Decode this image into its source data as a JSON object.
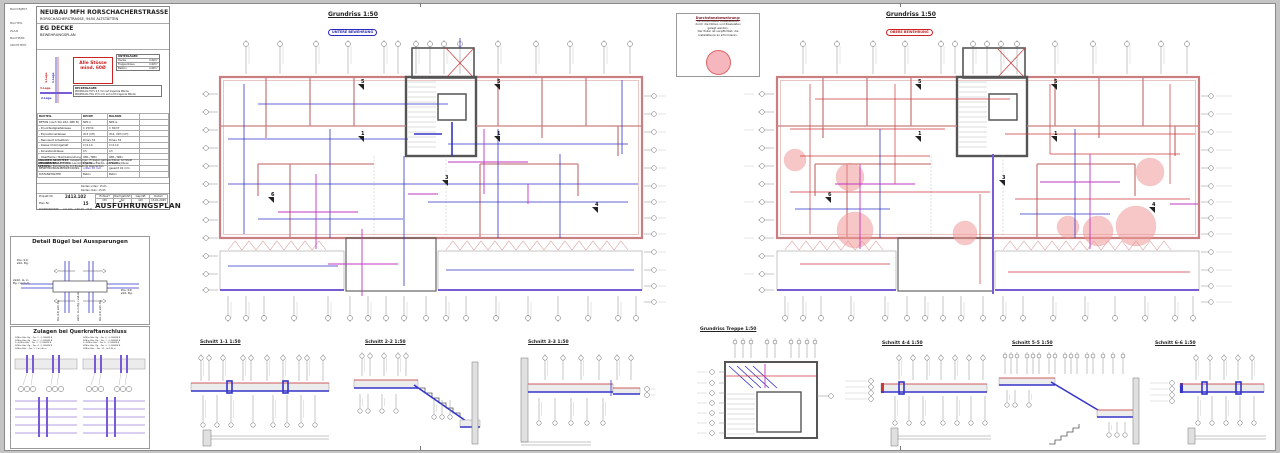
{
  "colors": {
    "red": "#cc3838",
    "blue": "#3434c8",
    "magenta": "#c234c2",
    "purple": "#7a5bd6",
    "wall_pink": "#c97f7f",
    "zone_pink": "#f29a9a"
  },
  "title_block": {
    "side_labels": [
      "BAUOBJEKT",
      "BAUTEIL",
      "PLAN",
      "BAUHERR",
      "ARCHITEKT"
    ],
    "project_name": "NEUBAU MFH RORSCHACHERSTRASSE",
    "project_address": "RORSCHACHERSTRASSE, 9450 ALTSTÄTTEN",
    "part": "EG DECKE",
    "plan_kind": "BEWEHRUNGSPLAN",
    "lage": {
      "l1": "1.Lage",
      "l2": "2.Lage",
      "l3": "3.Lage",
      "l4": "4.Lage"
    },
    "stoss1": "Alle Stösse",
    "stoss2": "mind. 60Ø",
    "unterlagen": {
      "title": "UNTERLAGEN",
      "rows": [
        {
          "k": "Decke",
          "v": "4 Ø/m²"
        },
        {
          "k": "Treppenhaus",
          "v": "4 Ø/m²"
        },
        {
          "k": "Balkon",
          "v": "4 Ø/m²"
        }
      ]
    },
    "lager": {
      "title": "DECKENLAGER:",
      "line1": "PROMOLOG TOTL 0.5 mm auf tragende Wände",
      "line2": "PROMOLOG TWL 15.5 mm auf nicht tragende Wände"
    },
    "materials": {
      "headers": [
        "BAUTEIL",
        "DECKE",
        "BALKON"
      ],
      "rows": [
        [
          "BETON (nach SIA 262, NPK B)",
          "NPK C",
          "NPK G"
        ],
        [
          "- Druckfestigkeitsklasse",
          "C 25/30",
          "C 30/37"
        ],
        [
          "- Expositionsklassen",
          "XC3 (CH)",
          "XC4, XD3 (CH)"
        ],
        [
          "- Nennwert Grösstkorn",
          "Dmax 32",
          "Dmax 32"
        ],
        [
          "- Klasse Chloridgehalt",
          "Cl 0,10",
          "Cl 0,10"
        ],
        [
          "- Konsistenzklasse",
          "C3",
          "C3"
        ],
        [
          "- Oberfläche / Nachbehandlung",
          "OB1 / NB1",
          "OB1 / NB1"
        ],
        [
          "BETONSTAHL",
          "B500B",
          "B500B"
        ],
        [
          "BEWEHRUNGSÜBERDECKUNG",
          "unten 30 mm",
          "gesamt 40 mm"
        ],
        [
          "DISTANZHALTER",
          "Beton",
          "Beton"
        ]
      ]
    },
    "angaben": [
      {
        "k": "ANGABEN ARCHITEKT:",
        "v": "Aussparungen, Einlagen gemäss Plänen Architekt"
      },
      {
        "k": "ANGABEN BAULEITUNG:",
        "v": "Leerrohre gemäss Elektro- und Sanitärplänen"
      },
      {
        "k": "SPEZIELL:",
        "v": "Durchbrüche mit Bauleitung absprechen"
      }
    ],
    "kanten1": "Kanten unten:  15.01",
    "kanten2": "Kanten oben:  15.05",
    "koord_label": "KOORDINATION:",
    "koord_line": "A-S.011 · 140.05 · 44.B",
    "project_no_label": "Projekt Nr.",
    "project_no": "2413.102",
    "plan_no_label": "Plan Nr.",
    "plan_no": "15",
    "approvals": {
      "h1": "Entwurf",
      "h2": "Nachgeführt",
      "h3": "Geprüft",
      "h4": "Datum",
      "v1": "CM",
      "v2": "AO",
      "v3": "GM",
      "v4": "13.01.2025"
    },
    "main_title": "AUSFÜHRUNGSPLAN"
  },
  "detail_buegel": {
    "title": "Detail Bügel bei Aussparungen",
    "pos11a": "Pos (11)",
    "pos11b": "ø10, Bg.",
    "ll_a": "2ø10, LL in",
    "ll_b": "Bg. rundum",
    "pos12a": "Pos (12)",
    "pos12b": "ø10, Bg.",
    "rot1": "Pos (13) ø10, Bg.",
    "rot2": "2ø10, LL in Bg. rundum",
    "rot3": "Pos (13) ø10, Bg."
  },
  "zulagen": {
    "title": "Zulagen bei Querkraftanschluss",
    "notes_left": [
      "3Ø8/m Bde. Bg. · Pos. 1 · Q-188/Ø8 B",
      "3Ø8/m Bde. Bg. · Pos. 2 · Q-188/Ø8 B",
      "2×3Ø8/m Bde. · Pos. 3 · Q-188/Ø8 B",
      "3Ø8/m Bde. Bg. · Pos. 4 · Q-188/Ø8 B",
      "3Ø8/m Bde. · Pos. 5 · L=1.40 m"
    ],
    "notes_right": [
      "3Ø8/m Bde. Bg. · Pos. 6 · Q-188/Ø8 B",
      "3Ø8/m Bde. Bg. · Pos. 7 · Q-188/Ø8 B",
      "2×3Ø8/m Bde. · Pos. 8 · Q-188/Ø8 B",
      "3Ø8/m Bde. Bg. · Pos. 9 · Q-188/Ø8 B",
      "3Ø8/m Bde. · Pos. 10 · L=1.40 m"
    ]
  },
  "plans": {
    "left": {
      "title": "Grundriss  1:50",
      "subtitle": "UNTERE BEWEHRUNG"
    },
    "right": {
      "title": "Grundriss  1:50",
      "subtitle": "OBERE BEWEHRUNG"
    }
  },
  "note_box": {
    "title": "Durchstanzbewehrung:",
    "l1": "Es dürfen keine Installationen",
    "l2": "durch die Dübel- und Rissleisten",
    "l3": "gelegt werden.",
    "l4": "Der Polier ist verpflichtet, die",
    "l5": "Installateure zu informieren."
  },
  "markers": {
    "m1": "1",
    "m3": "3",
    "m4": "4",
    "m5": "5",
    "m6": "6"
  },
  "sections": {
    "s11": "Schnitt 1-1  1:50",
    "s22": "Schnitt 2-2  1:50",
    "s33": "Schnitt 3-3  1:50",
    "treppe": "Grundriss Treppe  1:50",
    "s44": "Schnitt 4-4  1:50",
    "s55": "Schnitt 5-5  1:50",
    "s66": "Schnitt 6-6  1:50"
  }
}
